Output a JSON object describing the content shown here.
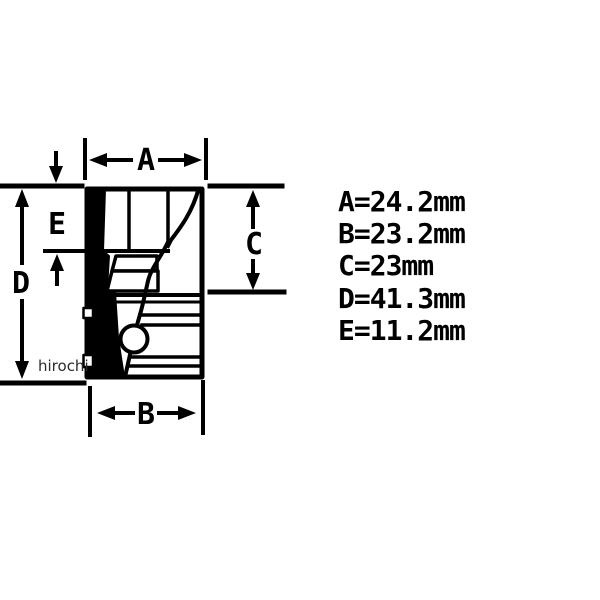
{
  "watermark": {
    "text": "hirochi"
  },
  "colors": {
    "ink": "#000000",
    "background": "#ffffff",
    "watermark": "#2b2b2b"
  },
  "diagram": {
    "dim_labels": {
      "a": "A",
      "b": "B",
      "c": "C",
      "d": "D",
      "e": "E"
    }
  },
  "measurements": [
    {
      "label": "A",
      "value": "24.2",
      "unit": "mm",
      "text": "A=24.2mm"
    },
    {
      "label": "B",
      "value": "23.2",
      "unit": "mm",
      "text": "B=23.2mm"
    },
    {
      "label": "C",
      "value": "23",
      "unit": "mm",
      "text": "C=23mm"
    },
    {
      "label": "D",
      "value": "41.3",
      "unit": "mm",
      "text": "D=41.3mm"
    },
    {
      "label": "E",
      "value": "11.2",
      "unit": "mm",
      "text": "E=11.2mm"
    }
  ]
}
